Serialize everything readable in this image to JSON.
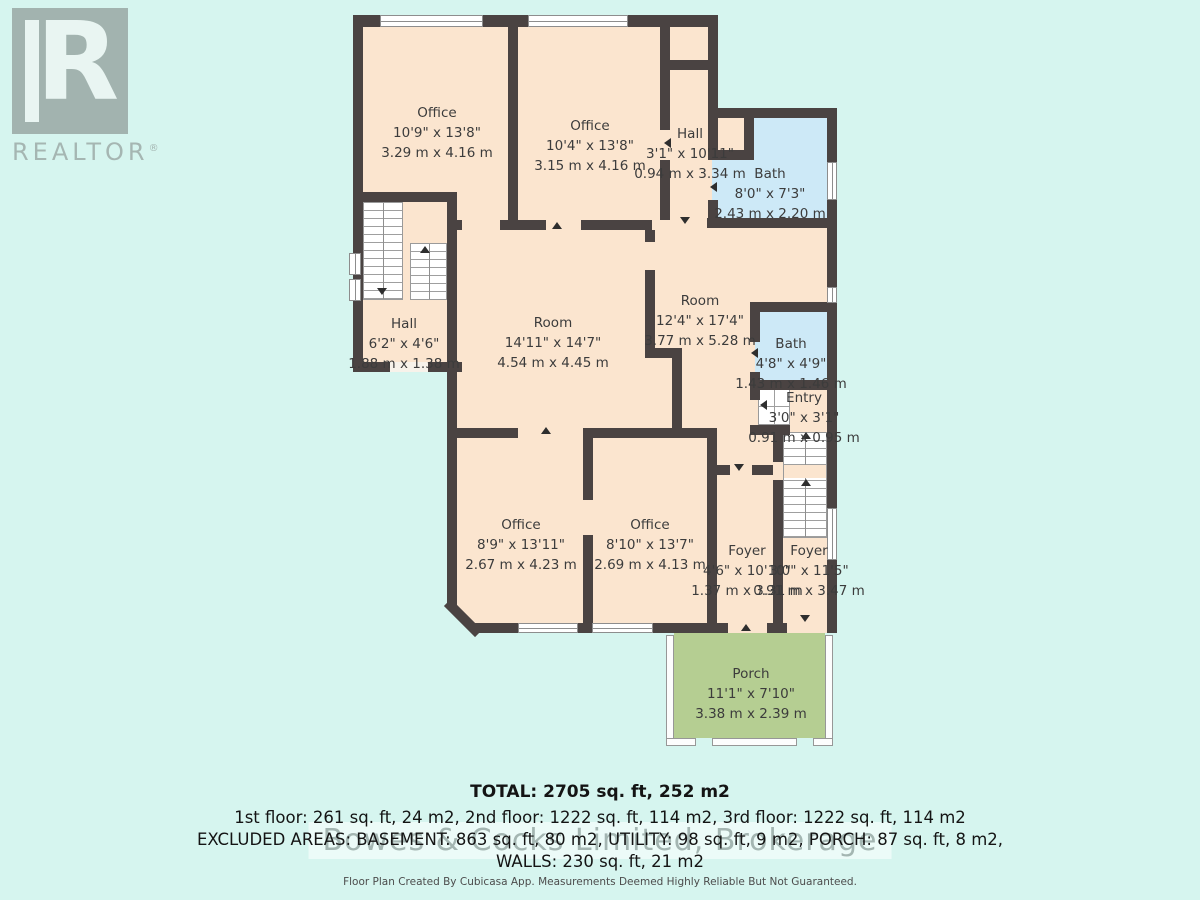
{
  "logo": {
    "letter": "R",
    "label": "REALTOR",
    "registered": "®"
  },
  "watermark": "Bowes & Cocks Limited, Brokerage",
  "rooms": [
    {
      "id": "office_tl",
      "name": "Office",
      "imperial": "10'9\" x 13'8\"",
      "metric": "3.29 m x 4.16 m"
    },
    {
      "id": "office_tm",
      "name": "Office",
      "imperial": "10'4\" x 13'8\"",
      "metric": "3.15 m x 4.16 m"
    },
    {
      "id": "hall_top",
      "name": "Hall",
      "imperial": "3'1\" x 10'11\"",
      "metric": "0.94 m x 3.34 m"
    },
    {
      "id": "bath_top",
      "name": "Bath",
      "imperial": "8'0\" x 7'3\"",
      "metric": "2.43 m x 2.20 m"
    },
    {
      "id": "hall_left",
      "name": "Hall",
      "imperial": "6'2\" x 4'6\"",
      "metric": "1.88 m x 1.38 m"
    },
    {
      "id": "room_main",
      "name": "Room",
      "imperial": "14'11\" x 14'7\"",
      "metric": "4.54 m x 4.45 m"
    },
    {
      "id": "room_right",
      "name": "Room",
      "imperial": "12'4\" x 17'4\"",
      "metric": "3.77 m x 5.28 m"
    },
    {
      "id": "bath_small",
      "name": "Bath",
      "imperial": "4'8\" x 4'9\"",
      "metric": "1.43 m x 1.46 m"
    },
    {
      "id": "entry",
      "name": "Entry",
      "imperial": "3'0\" x 3'1\"",
      "metric": "0.91 m x 0.95 m"
    },
    {
      "id": "office_bl",
      "name": "Office",
      "imperial": "8'9\" x 13'11\"",
      "metric": "2.67 m x 4.23 m"
    },
    {
      "id": "office_bm",
      "name": "Office",
      "imperial": "8'10\" x 13'7\"",
      "metric": "2.69 m x 4.13 m"
    },
    {
      "id": "foyer_1",
      "name": "Foyer",
      "imperial": "4'6\" x 10'10\"",
      "metric": "1.37 m x 3.31 m"
    },
    {
      "id": "foyer_2",
      "name": "Foyer",
      "imperial": "3'0\" x 11'5\"",
      "metric": "0.91 m x 3.47 m"
    },
    {
      "id": "porch",
      "name": "Porch",
      "imperial": "11'1\" x 7'10\"",
      "metric": "3.38 m x 2.39 m"
    }
  ],
  "summary": {
    "total_line": "TOTAL: 2705 sq. ft, 252 m2",
    "floors_line": "1st floor: 261 sq. ft, 24 m2, 2nd floor: 1222 sq. ft, 114 m2, 3rd floor: 1222 sq. ft, 114 m2",
    "excluded_line": "EXCLUDED AREAS: BASEMENT: 863 sq. ft, 80 m2, UTILITY: 98 sq. ft, 9 m2, PORCH: 87 sq. ft, 8 m2,",
    "walls_line": "WALLS: 230 sq. ft, 21 m2"
  },
  "footer": "Floor Plan Created By Cubicasa App. Measurements Deemed Highly Reliable But Not Guaranteed.",
  "colors": {
    "background": "#d6f5ef",
    "room_fill": "#fbe5cf",
    "bath_fill": "#cde9f7",
    "porch_fill": "#b5ce92",
    "wall": "#4a4342",
    "label_text": "#3c3c3c"
  }
}
